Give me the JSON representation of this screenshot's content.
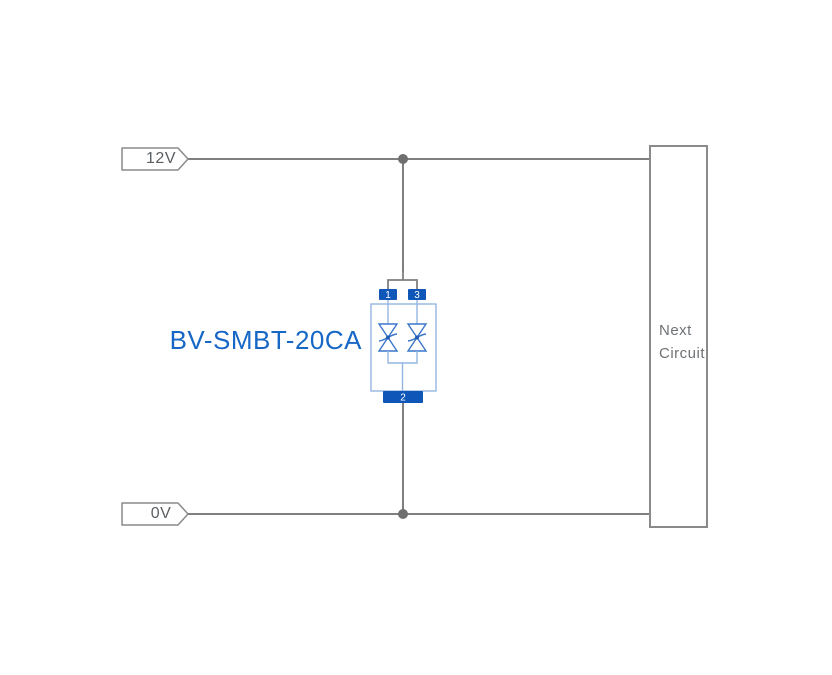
{
  "diagram": {
    "rails": {
      "top": {
        "label": "12V"
      },
      "bottom": {
        "label": "0V"
      }
    },
    "component": {
      "label": "BV-SMBT-20CA",
      "type": "bidirectional-tvs-diode-array",
      "pins": {
        "pin1": "1",
        "pin2": "2",
        "pin3": "3"
      }
    },
    "next_circuit": {
      "line1": "Next",
      "line2": "Circuit"
    }
  },
  "colors": {
    "wire": "#7f7f7f",
    "junction": "#6f6f6f",
    "tag-border": "#8a8a8a",
    "tag-text": "#5a5e63",
    "box-border": "#8a8a8a",
    "box-text": "#6e7276",
    "pin-blue": "#0e56b8",
    "light-blue": "#93b6e0",
    "diode-blue": "#3a76ca",
    "dot-blue": "#1f5cb2",
    "label-blue": "#1767c6",
    "bg": "#ffffff"
  }
}
